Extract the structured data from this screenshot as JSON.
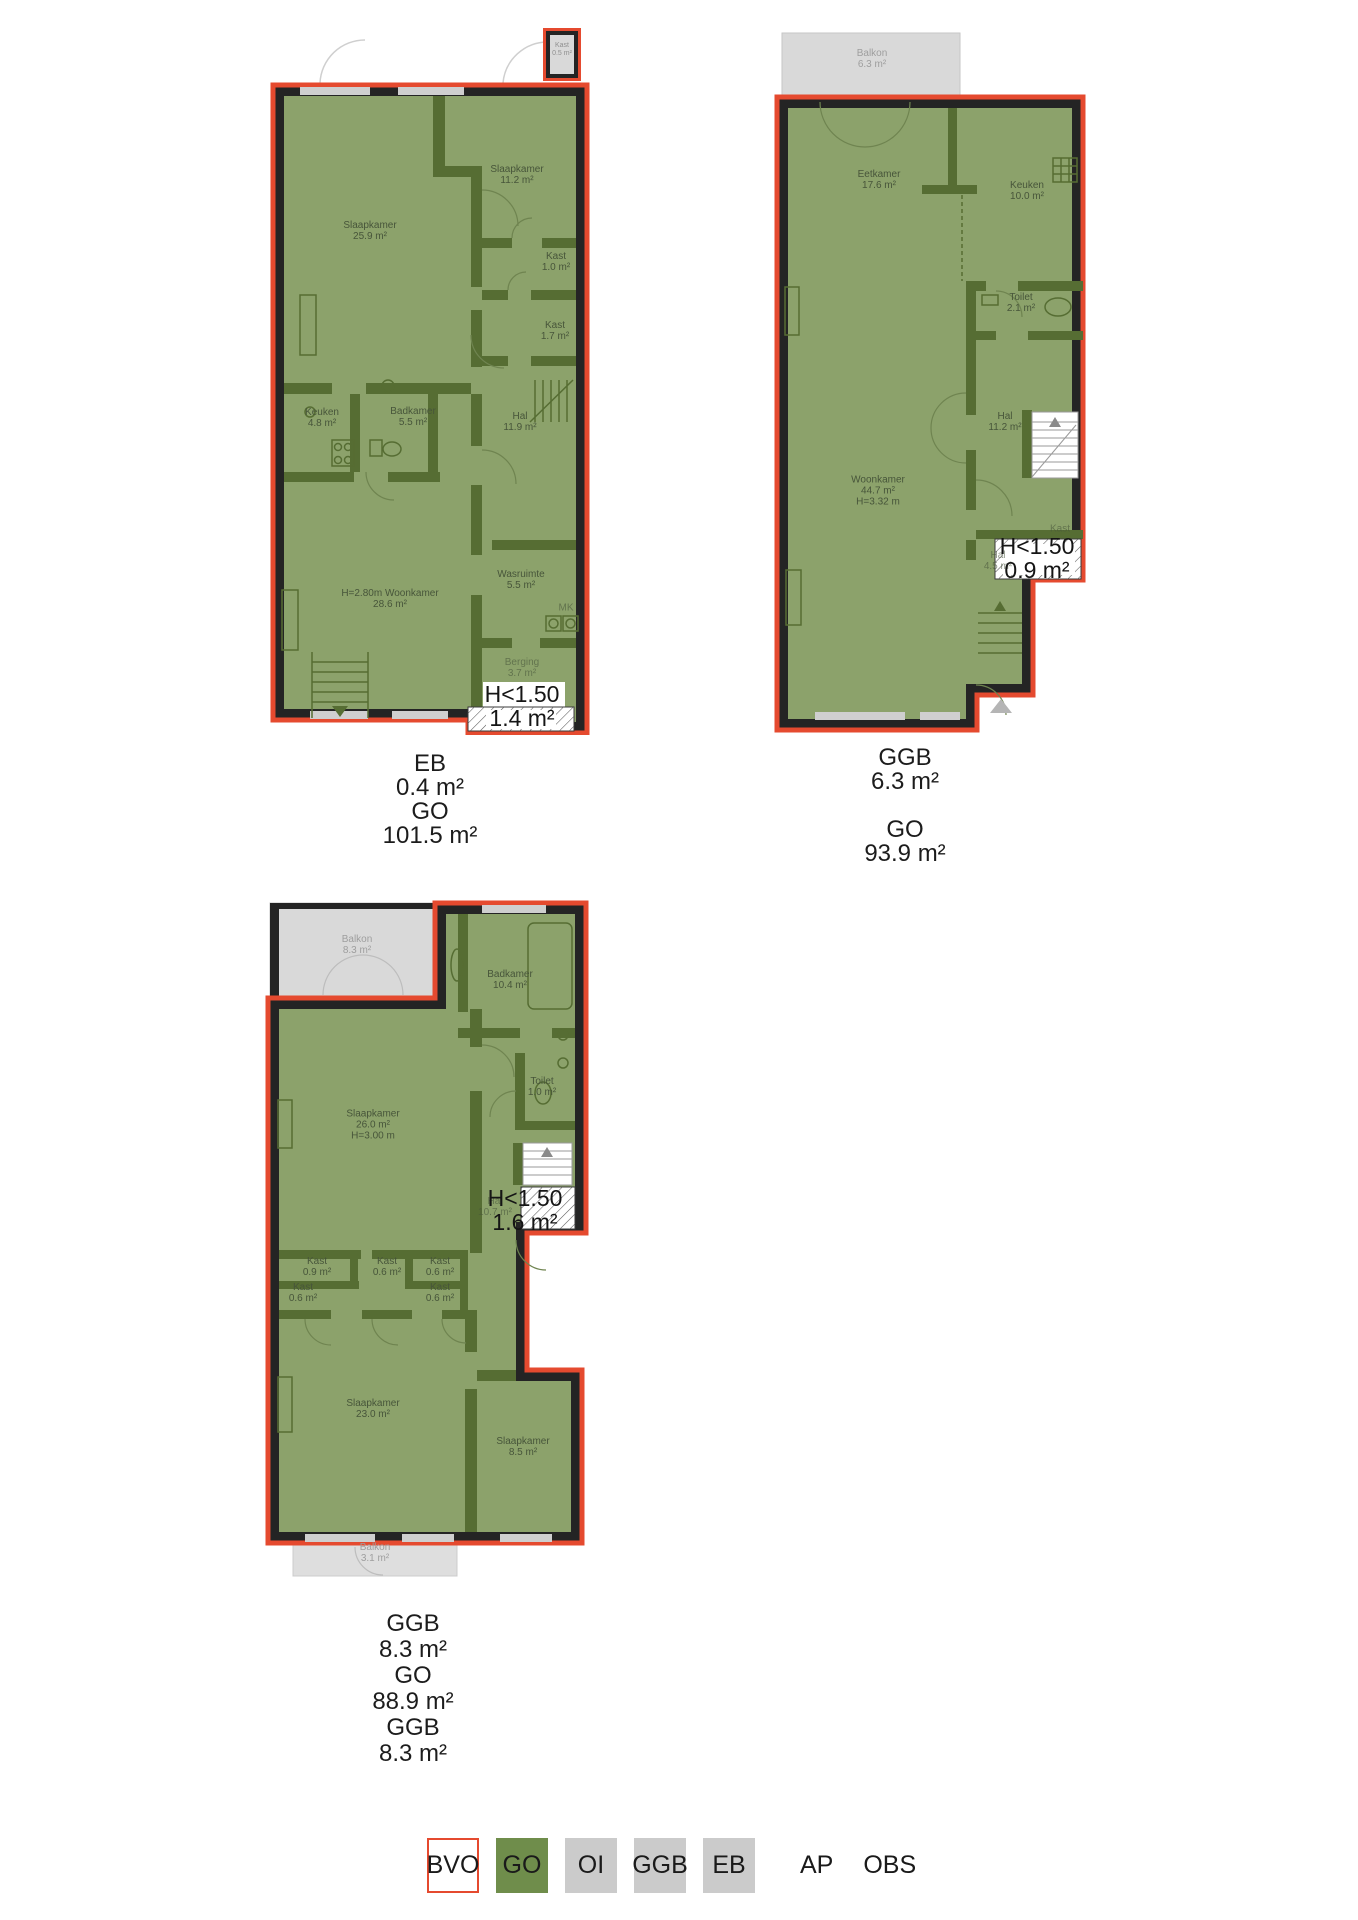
{
  "colors": {
    "plan_fill": "#8CA26B",
    "interior_wall": "#566D33",
    "perimeter_wall": "#242424",
    "outline_red": "#E54A2F",
    "balcony_gray": "#D9D9D9",
    "legend_green": "#6F8D4B",
    "legend_gray": "#CBCBCB"
  },
  "plans": [
    {
      "name": "floor-1",
      "closet_badge": {
        "name": "Kast",
        "area": "0.5 m²"
      },
      "rooms": [
        {
          "name": "Slaapkamer",
          "area": "25.9 m²"
        },
        {
          "name": "Slaapkamer",
          "area": "11.2 m²"
        },
        {
          "name": "Kast",
          "area": "1.0 m²"
        },
        {
          "name": "Kast",
          "area": "1.7 m²"
        },
        {
          "name": "Keuken",
          "area": "4.8 m²"
        },
        {
          "name": "Badkamer",
          "area": "5.5 m²"
        },
        {
          "name": "Hal",
          "area": "11.9 m²"
        },
        {
          "name": "Wasruimte",
          "area": "5.5 m²"
        },
        {
          "name": "Woonkamer",
          "area": "28.6 m²",
          "height": "H=2.80m"
        },
        {
          "name": "MK",
          "area": ""
        },
        {
          "name": "Berging",
          "area": "3.7 m²"
        }
      ],
      "low_headroom": {
        "label": "H<1.50",
        "area": "1.4 m²"
      },
      "caption": [
        "EB",
        "0.4 m²",
        "GO",
        "101.5 m²"
      ]
    },
    {
      "name": "floor-2",
      "balcony": {
        "name": "Balkon",
        "area": "6.3 m²"
      },
      "rooms": [
        {
          "name": "Eetkamer",
          "area": "17.6 m²"
        },
        {
          "name": "Keuken",
          "area": "10.0 m²"
        },
        {
          "name": "Toilet",
          "area": "2.1 m²"
        },
        {
          "name": "Hal",
          "area": "11.2 m²"
        },
        {
          "name": "Woonkamer",
          "area": "44.7 m²",
          "height": "H=3.32 m"
        },
        {
          "name": "Kast",
          "area": ""
        },
        {
          "name": "Hal",
          "area": "4.5 m²"
        }
      ],
      "low_headroom": {
        "label": "H<1.50",
        "area": "0.9 m²"
      },
      "caption": [
        "GGB",
        "6.3 m²",
        "",
        "GO",
        "93.9 m²"
      ]
    },
    {
      "name": "floor-3",
      "balcony_top": {
        "name": "Balkon",
        "area": "8.3 m²"
      },
      "balcony_bottom": {
        "name": "Balkon",
        "area": "3.1 m²"
      },
      "rooms": [
        {
          "name": "Badkamer",
          "area": "10.4 m²"
        },
        {
          "name": "Toilet",
          "area": "1.0 m²"
        },
        {
          "name": "Slaapkamer",
          "area": "26.0 m²",
          "height": "H=3.00 m"
        },
        {
          "name": "Hal",
          "area": "10.7 m²"
        },
        {
          "name": "Kast",
          "area": "0.9 m²"
        },
        {
          "name": "Kast",
          "area": "0.6 m²"
        },
        {
          "name": "Kast",
          "area": "0.6 m²"
        },
        {
          "name": "Kast",
          "area": "0.6 m²"
        },
        {
          "name": "Kast",
          "area": "0.6 m²"
        },
        {
          "name": "Slaapkamer",
          "area": "23.0 m²"
        },
        {
          "name": "Slaapkamer",
          "area": "8.5 m²"
        }
      ],
      "low_headroom": {
        "label": "H<1.50",
        "area": "1.6 m²"
      },
      "caption": [
        "GGB",
        "8.3 m²",
        "GO",
        "88.9 m²",
        "GGB",
        "8.3 m²"
      ]
    }
  ],
  "legend": {
    "items": [
      {
        "label": "BVO",
        "swatch": "outlined-white"
      },
      {
        "label": "GO",
        "swatch": "green"
      },
      {
        "label": "OI",
        "swatch": "gray"
      },
      {
        "label": "GGB",
        "swatch": "gray"
      },
      {
        "label": "EB",
        "swatch": "gray"
      },
      {
        "label": "AP",
        "swatch": "none"
      },
      {
        "label": "OBS",
        "swatch": "none"
      }
    ]
  }
}
